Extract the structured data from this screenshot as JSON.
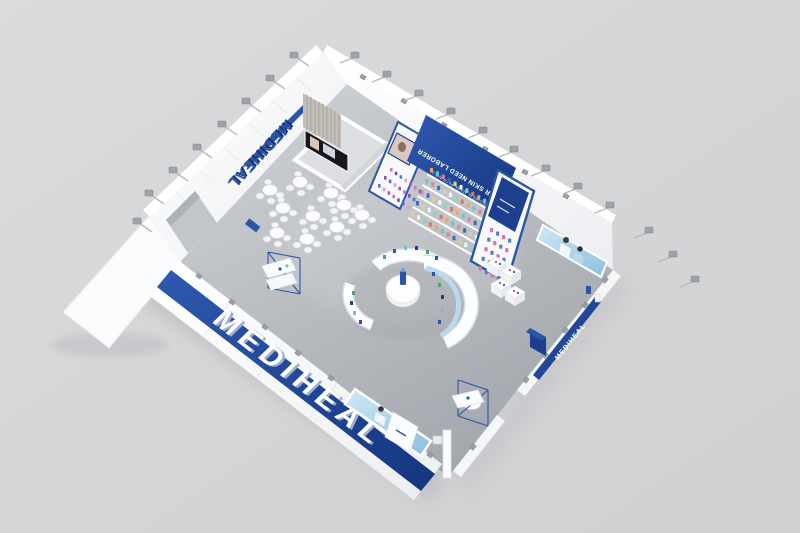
{
  "scene": {
    "description": "Aerial 3D render of a white-and-blue branded exhibition booth with cafe seating, product display wall, circular demo counters and perimeter spotlights"
  },
  "palette": {
    "background": "#d5d6d7",
    "floor_light": "#cdd0d4",
    "floor_dark": "#a4a8ae",
    "wall_white": "#f8f9fa",
    "wall_shade": "#e9ebee",
    "brand_blue": "#2d55a5",
    "brand_blue_dark": "#16336f",
    "banner_blue": "#1c3f8e",
    "screen_blue_light": "#cfe8f6",
    "screen_blue_dark": "#8fbede",
    "curtain_gray": "#c3beb8",
    "fixture_gray": "#9ea3a8"
  },
  "signs": {
    "front_wall_logo": "MEDIHEAL",
    "side_wall_banner": "MEDIHEAL",
    "interior_wall_logo": "MEDIHEAL",
    "back_wall_banner_line1": "OH! YOUR SKIN NEED LABORER",
    "back_wall_banner_line2": "MEDIHEAL MASK PACK NO.1"
  },
  "product_grids": {
    "mask_wall": {
      "rows": 5,
      "cols": 13,
      "colors": [
        "#f2a65e",
        "#6fc3d0",
        "#e97ba8",
        "#3f69b5",
        "#e3cd8f",
        "#f4f6f8",
        "#8fd0c0",
        "#d9775f"
      ]
    },
    "display_case": {
      "rows": 3,
      "cols": 7,
      "colors": [
        "#d66fae",
        "#7a4fb5",
        "#4f74c9",
        "#e59ad0",
        "#b14fd0"
      ]
    },
    "tower": {
      "rows": 5,
      "cols": 4,
      "colors": [
        "#e06fa8",
        "#5d7fc9"
      ]
    }
  }
}
